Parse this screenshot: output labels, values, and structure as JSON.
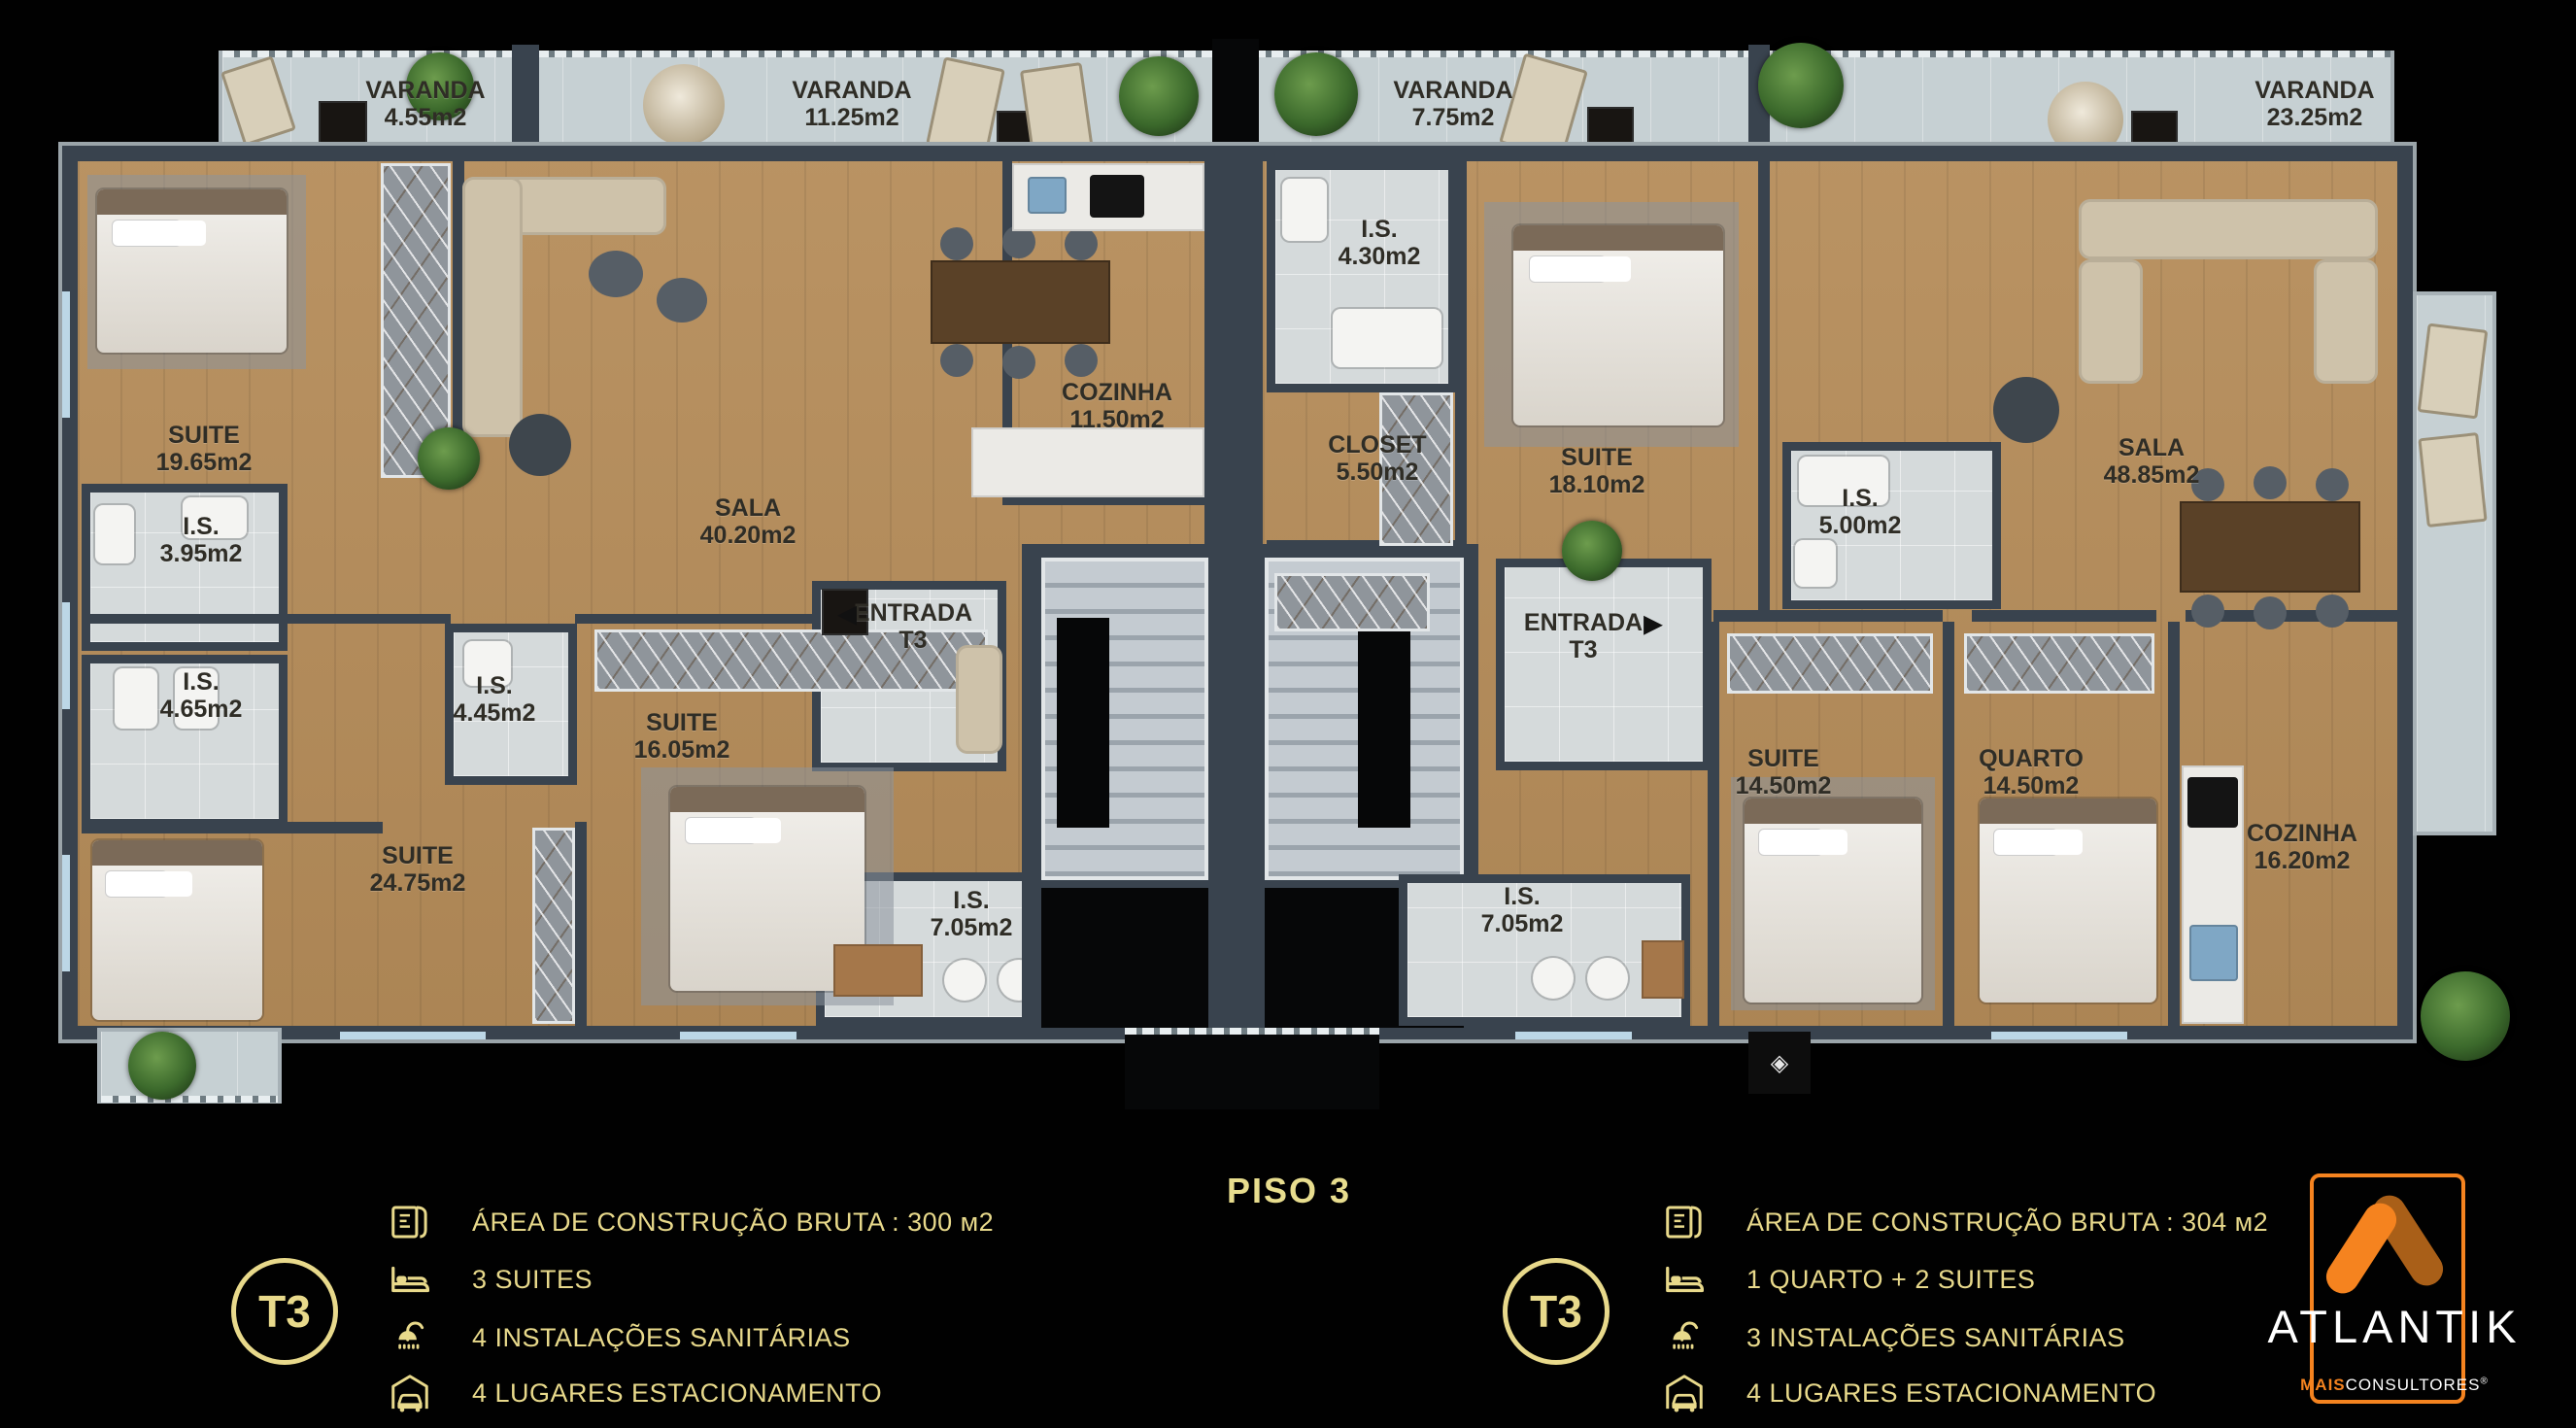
{
  "title": "PISO 3",
  "colors": {
    "gold": "#e8d98b",
    "orange": "#f5831f",
    "wall": "#39434e",
    "wood": "#b58c59"
  },
  "icons": {
    "entry_arrow_left": "◀",
    "entry_arrow_right": "▶",
    "cube": "◈"
  },
  "balconies": [
    {
      "name": "VARANDA",
      "area": "4.55m2"
    },
    {
      "name": "VARANDA",
      "area": "11.25m2"
    },
    {
      "name": "VARANDA",
      "area": "7.75m2"
    },
    {
      "name": "VARANDA",
      "area": "23.25m2"
    }
  ],
  "unit_left": {
    "rooms": [
      {
        "name": "SUITE",
        "area": "19.65m2"
      },
      {
        "name": "I.S.",
        "area": "3.95m2"
      },
      {
        "name": "I.S.",
        "area": "4.65m2"
      },
      {
        "name": "SUITE",
        "area": "24.75m2"
      },
      {
        "name": "I.S.",
        "area": "4.45m2"
      },
      {
        "name": "SUITE",
        "area": "16.05m2"
      },
      {
        "name": "SALA",
        "area": "40.20m2"
      },
      {
        "name": "COZINHA",
        "area": "11.50m2"
      },
      {
        "name": "ENTRADA",
        "area": "T3"
      },
      {
        "name": "I.S.",
        "area": "7.05m2"
      }
    ]
  },
  "unit_right": {
    "rooms": [
      {
        "name": "I.S.",
        "area": "4.30m2"
      },
      {
        "name": "CLOSET",
        "area": "5.50m2"
      },
      {
        "name": "SUITE",
        "area": "18.10m2"
      },
      {
        "name": "I.S.",
        "area": "5.00m2"
      },
      {
        "name": "SALA",
        "area": "48.85m2"
      },
      {
        "name": "ENTRADA",
        "area": "T3"
      },
      {
        "name": "SUITE",
        "area": "14.50m2"
      },
      {
        "name": "QUARTO",
        "area": "14.50m2"
      },
      {
        "name": "COZINHA",
        "area": "16.20m2"
      },
      {
        "name": "I.S.",
        "area": "7.05m2"
      }
    ]
  },
  "legend_left": {
    "badge": "T3",
    "items": [
      {
        "icon": "floor-plan-icon",
        "text": "ÁREA DE CONSTRUÇÃO BRUTA :  300 м2"
      },
      {
        "icon": "bed-icon",
        "text": "3 SUITES"
      },
      {
        "icon": "shower-icon",
        "text": "4 INSTALAÇÕES SANITÁRIAS"
      },
      {
        "icon": "car-garage-icon",
        "text": "4 LUGARES ESTACIONAMENTO"
      }
    ]
  },
  "legend_right": {
    "badge": "T3",
    "items": [
      {
        "icon": "floor-plan-icon",
        "text": "ÁREA DE CONSTRUÇÃO BRUTA :  304 м2"
      },
      {
        "icon": "bed-icon",
        "text": "1 QUARTO + 2 SUITES"
      },
      {
        "icon": "shower-icon",
        "text": "3 INSTALAÇÕES SANITÁRIAS"
      },
      {
        "icon": "car-garage-icon",
        "text": "4 LUGARES ESTACIONAMENTO"
      }
    ]
  },
  "brand": {
    "name": "ATLANTIK",
    "sub_bold": "MAIS",
    "sub_rest": "CONSULTORES",
    "reg": "®"
  }
}
